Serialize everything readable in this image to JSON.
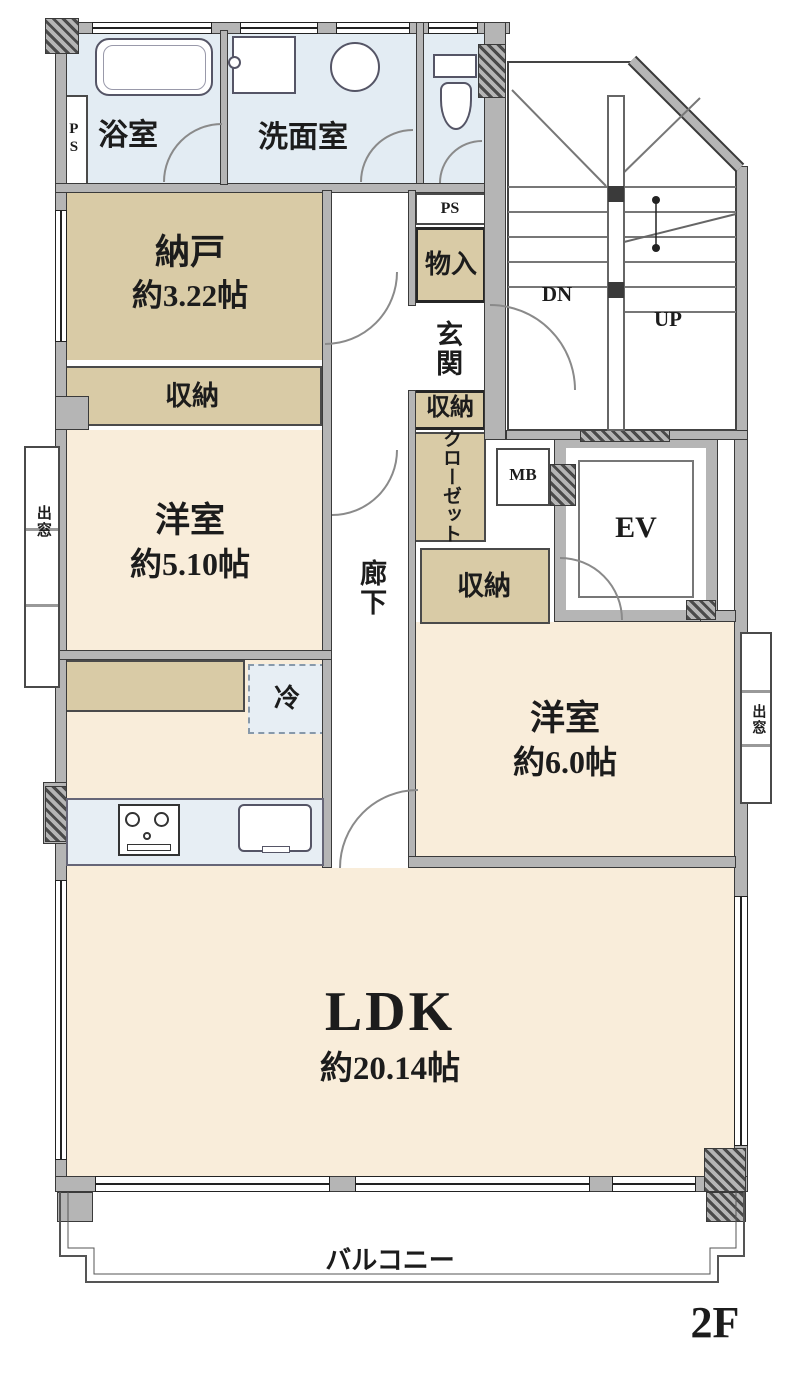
{
  "floor": {
    "tag": "2F"
  },
  "rooms": {
    "bathroom": {
      "label": "浴室"
    },
    "washroom": {
      "label": "洗面室"
    },
    "storage_room": {
      "label": "納戸",
      "size": "約3.22帖"
    },
    "western_room_1": {
      "label": "洋室",
      "size": "約5.10帖"
    },
    "western_room_2": {
      "label": "洋室",
      "size": "約6.0帖"
    },
    "ldk": {
      "label": "LDK",
      "size": "約20.14帖"
    },
    "hallway": {
      "label": "廊下"
    },
    "entrance": {
      "label": "玄関"
    },
    "balcony": {
      "label": "バルコニー"
    }
  },
  "storage": {
    "closet_nando": {
      "label": "収納"
    },
    "closet_entrance": {
      "label": "収納"
    },
    "closet_room2": {
      "label": "収納"
    },
    "storage_compartment": {
      "label": "物入"
    },
    "closet": {
      "label": "クローゼット"
    },
    "refrigerator": {
      "label": "冷"
    }
  },
  "features": {
    "ps_left": {
      "label": "PS"
    },
    "ps_right": {
      "label": "PS"
    },
    "meter_box": {
      "label": "MB"
    },
    "elevator": {
      "label": "EV"
    },
    "stairs_down": {
      "label": "DN"
    },
    "stairs_up": {
      "label": "UP"
    },
    "bay_window_left": {
      "label": "出窓"
    },
    "bay_window_right": {
      "label": "出窓"
    }
  },
  "colors": {
    "room_fill": "#f9edda",
    "closet_fill": "#d9cba6",
    "wet_area_fill": "#e3ecf3",
    "wall_fill": "#b5b5b5",
    "line": "#3a3a3a"
  }
}
